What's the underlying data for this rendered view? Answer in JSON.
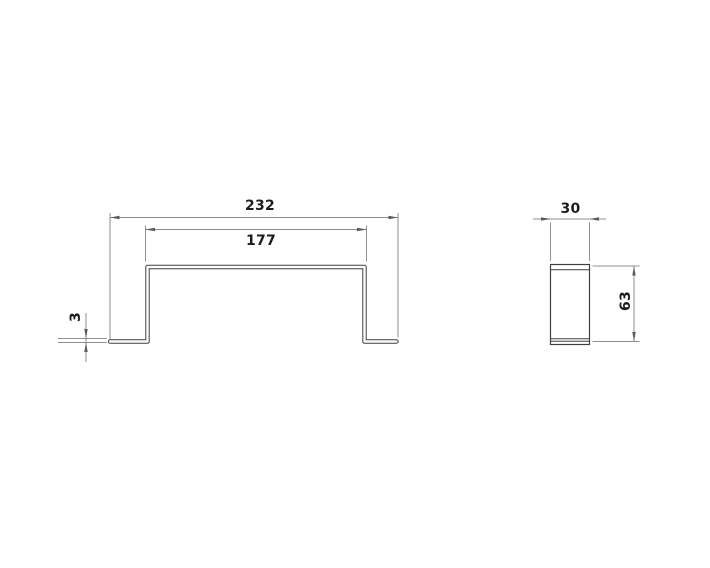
{
  "drawing": {
    "type": "technical-drawing",
    "part": "u-channel-bracket",
    "background_color": "#ffffff",
    "outline_color": "#3f3f3f",
    "dimension_line_color": "#8f8f8f",
    "arrow_color": "#5a5a5a",
    "text_color": "#1c1c1c",
    "views": [
      {
        "id": "front-view",
        "dimensions": [
          "232",
          "177",
          "3"
        ]
      },
      {
        "id": "side-view",
        "dimensions": [
          "30",
          "63"
        ]
      }
    ]
  },
  "labels": {
    "overall_width": "232",
    "top_width": "177",
    "material_thickness": "3",
    "depth": "30",
    "height": "63"
  }
}
